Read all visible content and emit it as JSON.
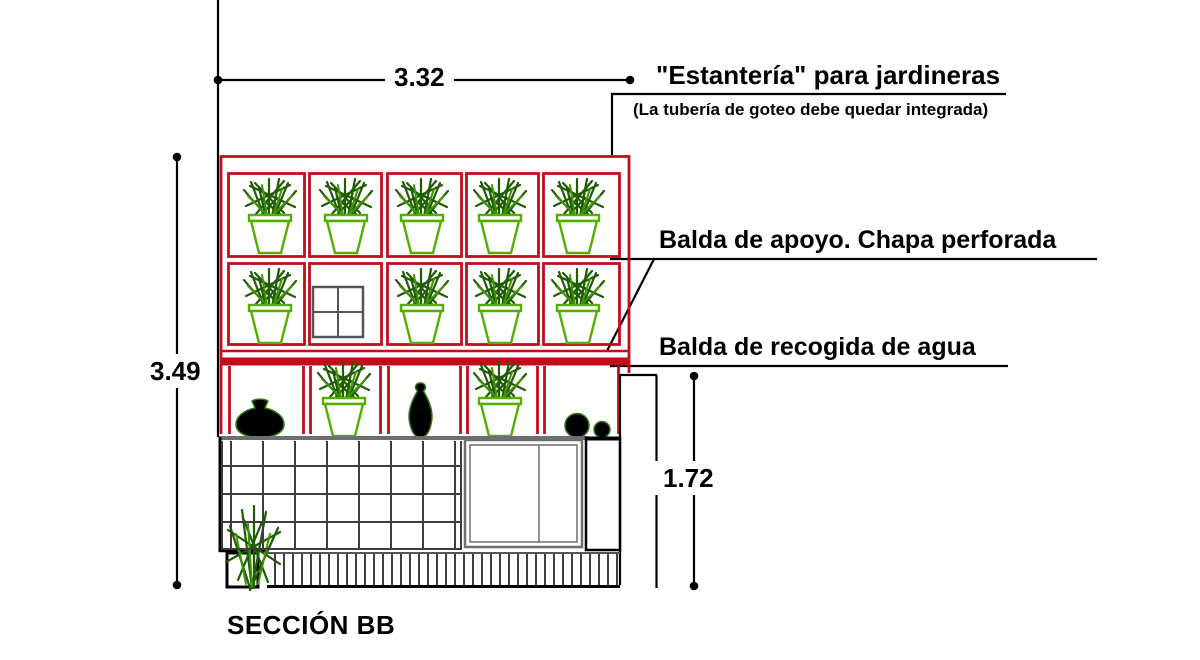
{
  "drawing": {
    "section_label": "SECCIÓN BB",
    "dimensions": {
      "width_m": "3.32",
      "total_height_m": "3.49",
      "counter_height_m": "1.72"
    },
    "annotations": {
      "shelving_title": "\"Estantería\" para jardineras",
      "shelving_note": "(La tubería de goteo debe quedar integrada)",
      "support_shelf_label": "Balda de apoyo. Chapa perforada",
      "water_shelf_label": "Balda de recogida de agua"
    },
    "colors": {
      "frame_red": "#c20d1d",
      "pot_green": "#54ae00",
      "leaf_green": "#1f5c05",
      "leaf_bright": "#3f9500",
      "ink_black": "#000000",
      "tile_gray": "#3d3d3d",
      "panel_gray": "#6e6e6e"
    }
  }
}
